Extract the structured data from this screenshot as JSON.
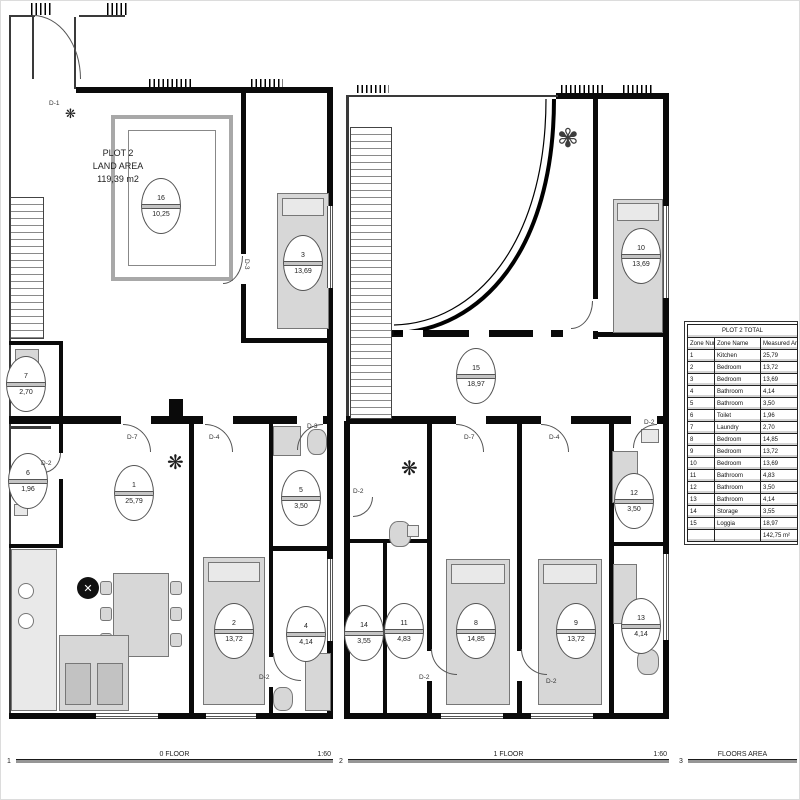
{
  "plot_label": {
    "line1": "PLOT 2",
    "line2": "LAND AREA",
    "line3": "119,39 m2"
  },
  "floor0": {
    "rooms": [
      {
        "number": "16",
        "area": "10,25",
        "x": 140,
        "y": 177
      },
      {
        "number": "3",
        "area": "13,69",
        "x": 282,
        "y": 234
      },
      {
        "number": "7",
        "area": "2,70",
        "x": 5,
        "y": 355
      },
      {
        "number": "6",
        "area": "1,96",
        "x": 7,
        "y": 452
      },
      {
        "number": "1",
        "area": "25,79",
        "x": 113,
        "y": 464
      },
      {
        "number": "5",
        "area": "3,50",
        "x": 280,
        "y": 469
      },
      {
        "number": "2",
        "area": "13,72",
        "x": 213,
        "y": 602
      },
      {
        "number": "4",
        "area": "4,14",
        "x": 285,
        "y": 605
      }
    ],
    "doors": [
      {
        "label": "D-1",
        "x": 48,
        "y": 100
      },
      {
        "label": "D-3",
        "x": 248,
        "y": 258,
        "v": true
      },
      {
        "label": "D-7",
        "x": 126,
        "y": 434
      },
      {
        "label": "D-4",
        "x": 208,
        "y": 434
      },
      {
        "label": "D-3",
        "x": 306,
        "y": 423
      },
      {
        "label": "D-2",
        "x": 40,
        "y": 460
      },
      {
        "label": "D-2",
        "x": 258,
        "y": 674
      }
    ]
  },
  "floor1": {
    "rooms": [
      {
        "number": "15",
        "area": "18,97",
        "x": 455,
        "y": 347
      },
      {
        "number": "10",
        "area": "13,69",
        "x": 620,
        "y": 227
      },
      {
        "number": "14",
        "area": "3,55",
        "x": 343,
        "y": 604
      },
      {
        "number": "11",
        "area": "4,83",
        "x": 383,
        "y": 602
      },
      {
        "number": "8",
        "area": "14,85",
        "x": 455,
        "y": 602
      },
      {
        "number": "9",
        "area": "13,72",
        "x": 555,
        "y": 602
      },
      {
        "number": "12",
        "area": "3,50",
        "x": 613,
        "y": 472
      },
      {
        "number": "13",
        "area": "4,14",
        "x": 620,
        "y": 597
      }
    ],
    "doors": [
      {
        "label": "D-7",
        "x": 463,
        "y": 434
      },
      {
        "label": "D-4",
        "x": 548,
        "y": 434
      },
      {
        "label": "D-2",
        "x": 643,
        "y": 419
      },
      {
        "label": "D-2",
        "x": 352,
        "y": 488
      },
      {
        "label": "D-2",
        "x": 418,
        "y": 674
      },
      {
        "label": "D-2",
        "x": 545,
        "y": 678
      }
    ]
  },
  "table": {
    "title": "PLOT 2 TOTAL",
    "columns": [
      "Zone Number",
      "Zone Name",
      "Measured Area"
    ],
    "rows": [
      [
        "1",
        "Kitchen",
        "25,79"
      ],
      [
        "2",
        "Bedroom",
        "13,72"
      ],
      [
        "3",
        "Bedroom",
        "13,69"
      ],
      [
        "4",
        "Bathroom",
        "4,14"
      ],
      [
        "5",
        "Bathroom",
        "3,50"
      ],
      [
        "6",
        "Toilet",
        "1,96"
      ],
      [
        "7",
        "Laundry",
        "2,70"
      ],
      [
        "8",
        "Bedroom",
        "14,85"
      ],
      [
        "9",
        "Bedroom",
        "13,72"
      ],
      [
        "10",
        "Bedroom",
        "13,69"
      ],
      [
        "11",
        "Bathroom",
        "4,83"
      ],
      [
        "12",
        "Bathroom",
        "3,50"
      ],
      [
        "13",
        "Bathroom",
        "4,14"
      ],
      [
        "14",
        "Storage",
        "3,55"
      ],
      [
        "15",
        "Loggia",
        "18,97"
      ]
    ],
    "total": "142,75 m²"
  },
  "footer": {
    "items": [
      {
        "num": "1",
        "label": "0 FLOOR",
        "scale": "1:60"
      },
      {
        "num": "2",
        "label": "1 FLOOR",
        "scale": "1:60"
      },
      {
        "num": "3",
        "label": "FLOORS AREA",
        "scale": ""
      }
    ]
  }
}
